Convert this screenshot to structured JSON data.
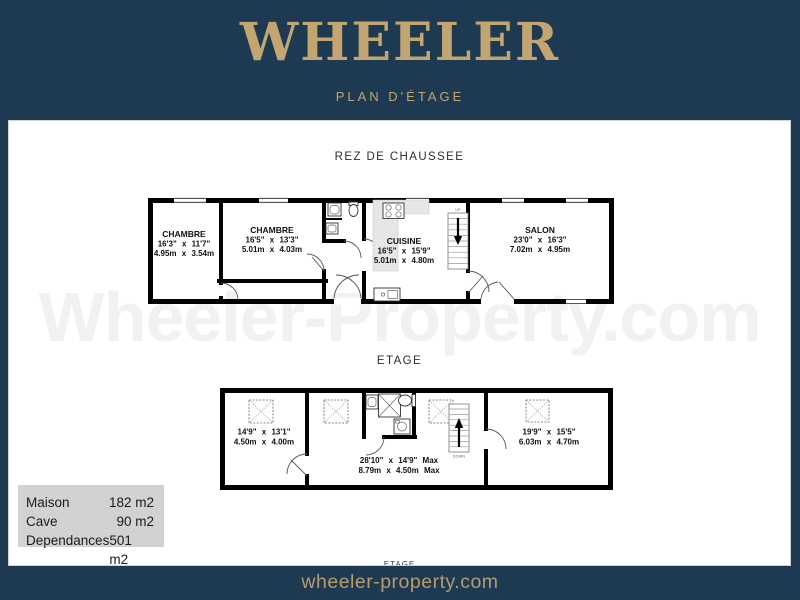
{
  "header": {
    "brand": "WHEELER",
    "subtitle": "PLAN D'ÉTAGE"
  },
  "watermark": "Wheeler-Property.com",
  "floors": [
    {
      "label": "REZ DE CHAUSSEE",
      "stair_label": "UP",
      "rooms": [
        {
          "name": "CHAMBRE",
          "imperial": "16'3\" x 11'7\"",
          "metric": "4.95m x 3.54m"
        },
        {
          "name": "CHAMBRE",
          "imperial": "16'5\" x 13'3\"",
          "metric": "5.01m x 4.03m"
        },
        {
          "name": "CUISINE",
          "imperial": "16'5\" x 15'9\"",
          "metric": "5.01m x 4.80m"
        },
        {
          "name": "SALON",
          "imperial": "23'0\" x 16'3\"",
          "metric": "7.02m x 4.95m"
        }
      ]
    },
    {
      "label": "ETAGE",
      "stair_label": "DOWN",
      "rooms": [
        {
          "name": "",
          "imperial": "14'9\" x 13'1\"",
          "metric": "4.50m x 4.00m"
        },
        {
          "name": "",
          "imperial": "28'10\" x 14'9\" Max",
          "metric": "8.79m x 4.50m Max"
        },
        {
          "name": "",
          "imperial": "19'9\" x 15'5\"",
          "metric": "6.03m x 4.70m"
        }
      ]
    }
  ],
  "legend": {
    "rows": [
      {
        "label": "Maison",
        "value": "182 m2"
      },
      {
        "label": "Cave",
        "value": "90 m2"
      },
      {
        "label": "Dependances",
        "value": "501 m2"
      }
    ]
  },
  "partial_floor_label": "ETAGE",
  "footer": {
    "site": "wheeler-property.com"
  },
  "colors": {
    "navy": "#1E3A52",
    "gold": "#C3A571",
    "wall": "#000000",
    "legend_bg": "#D2D2D2",
    "watermark_gray": "#F1F1F1"
  }
}
